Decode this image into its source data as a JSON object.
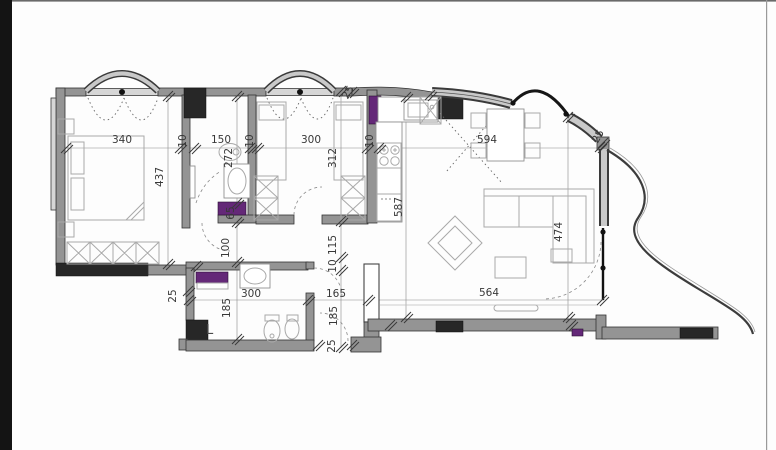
{
  "drawing": {
    "kind": "apartment-floor-plan",
    "rooms": {
      "laundry_label": "L"
    },
    "colors": {
      "wall": "#949494",
      "column": "#272727",
      "shaft": "#642878"
    },
    "dim_labels": [
      {
        "t": "340",
        "x": 122,
        "y": 143,
        "r": 0
      },
      {
        "t": "10",
        "x": 186,
        "y": 141,
        "r": -90
      },
      {
        "t": "150",
        "x": 221,
        "y": 143,
        "r": 0
      },
      {
        "t": "10",
        "x": 253,
        "y": 141,
        "r": -90
      },
      {
        "t": "300",
        "x": 311,
        "y": 143,
        "r": 0
      },
      {
        "t": "10",
        "x": 373,
        "y": 141,
        "r": -90
      },
      {
        "t": "594",
        "x": 487,
        "y": 143,
        "r": 0
      },
      {
        "t": "437",
        "x": 163,
        "y": 177,
        "r": -90
      },
      {
        "t": "272",
        "x": 232,
        "y": 158,
        "r": -90
      },
      {
        "t": "65",
        "x": 234,
        "y": 213,
        "r": -90
      },
      {
        "t": "100",
        "x": 229,
        "y": 248,
        "r": -90
      },
      {
        "t": "312",
        "x": 336,
        "y": 158,
        "r": -90
      },
      {
        "t": "115",
        "x": 336,
        "y": 245,
        "r": -90
      },
      {
        "t": "10",
        "x": 336,
        "y": 266,
        "r": -90
      },
      {
        "t": "587",
        "x": 402,
        "y": 207,
        "r": -90
      },
      {
        "t": "474",
        "x": 562,
        "y": 232,
        "r": -90
      },
      {
        "t": "300",
        "x": 251,
        "y": 297,
        "r": 0
      },
      {
        "t": "165",
        "x": 336,
        "y": 297,
        "r": 0
      },
      {
        "t": "564",
        "x": 489,
        "y": 296,
        "r": 0
      },
      {
        "t": "185",
        "x": 230,
        "y": 308,
        "r": -90
      },
      {
        "t": "185",
        "x": 337,
        "y": 316,
        "r": -90
      },
      {
        "t": "25",
        "x": 335,
        "y": 346,
        "r": -90
      },
      {
        "t": "25",
        "x": 176,
        "y": 296,
        "r": -90
      },
      {
        "t": "25",
        "x": 351,
        "y": 94,
        "r": -60
      },
      {
        "t": "25",
        "x": 601,
        "y": 138,
        "r": -60
      }
    ]
  }
}
